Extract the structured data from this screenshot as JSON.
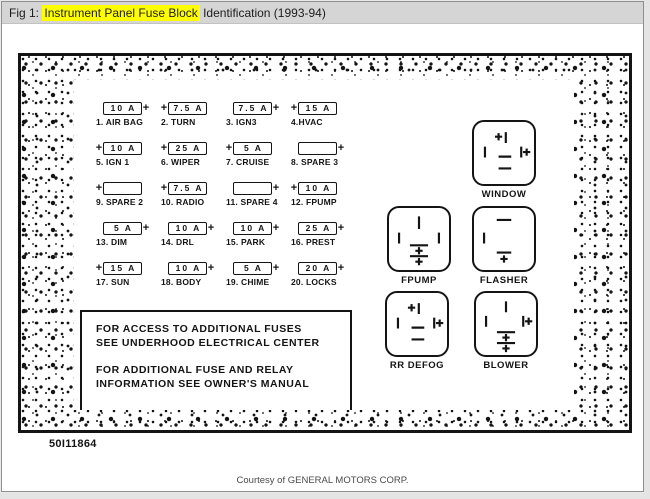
{
  "header": {
    "prefix": "Fig 1: ",
    "highlight": "Instrument Panel Fuse Block",
    "suffix": " Identification (1993-94)"
  },
  "diagram": {
    "fuses": [
      {
        "pre": "",
        "amp": "10 A",
        "post": "+",
        "label": "1. AIR BAG"
      },
      {
        "pre": "+",
        "amp": "7.5 A",
        "post": "",
        "label": "2. TURN"
      },
      {
        "pre": "",
        "amp": "7.5 A",
        "post": "+",
        "label": "3. IGN3"
      },
      {
        "pre": "+",
        "amp": "15 A",
        "post": "",
        "label": "4.HVAC"
      },
      {
        "pre": "+",
        "amp": "10 A",
        "post": "",
        "label": "5. IGN 1"
      },
      {
        "pre": "+",
        "amp": "25 A",
        "post": "",
        "label": "6. WIPER"
      },
      {
        "pre": "+",
        "amp": "5 A",
        "post": "",
        "label": "7. CRUISE"
      },
      {
        "pre": "",
        "amp": "",
        "post": "+",
        "label": "8. SPARE 3"
      },
      {
        "pre": "+",
        "amp": "",
        "post": "",
        "label": "9. SPARE 2"
      },
      {
        "pre": "+",
        "amp": "7.5 A",
        "post": "",
        "label": "10. RADIO"
      },
      {
        "pre": "",
        "amp": "",
        "post": "+",
        "label": "11. SPARE 4"
      },
      {
        "pre": "+",
        "amp": "10 A",
        "post": "",
        "label": "12. FPUMP"
      },
      {
        "pre": "",
        "amp": "5 A",
        "post": "+",
        "label": "13. DIM"
      },
      {
        "pre": "",
        "amp": "10 A",
        "post": "+",
        "label": "14. DRL"
      },
      {
        "pre": "",
        "amp": "10 A",
        "post": "+",
        "label": "15. PARK"
      },
      {
        "pre": "",
        "amp": "25 A",
        "post": "+",
        "label": "16. PREST"
      },
      {
        "pre": "+",
        "amp": "15 A",
        "post": "",
        "label": "17. SUN"
      },
      {
        "pre": "",
        "amp": "10 A",
        "post": "+",
        "label": "18. BODY"
      },
      {
        "pre": "",
        "amp": "5 A",
        "post": "+",
        "label": "19. CHIME"
      },
      {
        "pre": "",
        "amp": "20 A",
        "post": "+",
        "label": "20. LOCKS"
      }
    ],
    "relays": [
      {
        "label": "WINDOW"
      },
      {
        "label": "FPUMP"
      },
      {
        "label": "FLASHER"
      },
      {
        "label": "RR DEFOG"
      },
      {
        "label": "BLOWER"
      }
    ],
    "notes": [
      "FOR ACCESS TO ADDITIONAL FUSES",
      "SEE UNDERHOOD ELECTRICAL CENTER",
      "FOR ADDITIONAL FUSE AND RELAY",
      "INFORMATION SEE OWNER'S MANUAL"
    ],
    "figure_id": "50I11864"
  },
  "footer": {
    "courtesy": "Courtesy of GENERAL MOTORS CORP."
  },
  "colors": {
    "highlight": "#ffff00",
    "titlebar_bg": "#d5d5d5",
    "ink": "#141414"
  }
}
